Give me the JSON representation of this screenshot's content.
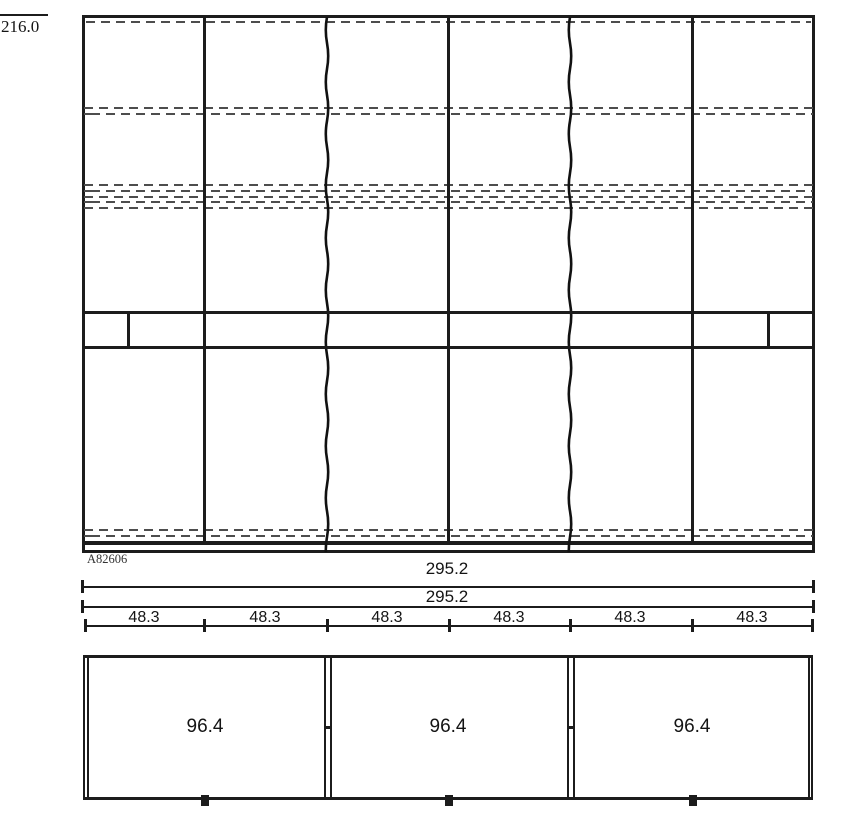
{
  "labels": {
    "height": "216.0",
    "part_code": "A82606",
    "overall_width_1": "295.2",
    "overall_width_2": "295.2",
    "section_widths": [
      "48.3",
      "48.3",
      "48.3",
      "48.3",
      "48.3",
      "48.3"
    ],
    "plan_widths": [
      "96.4",
      "96.4",
      "96.4"
    ]
  },
  "colors": {
    "line": "#1c1c1c",
    "hidden_line": "#4d4d4d",
    "background": "#ffffff"
  }
}
